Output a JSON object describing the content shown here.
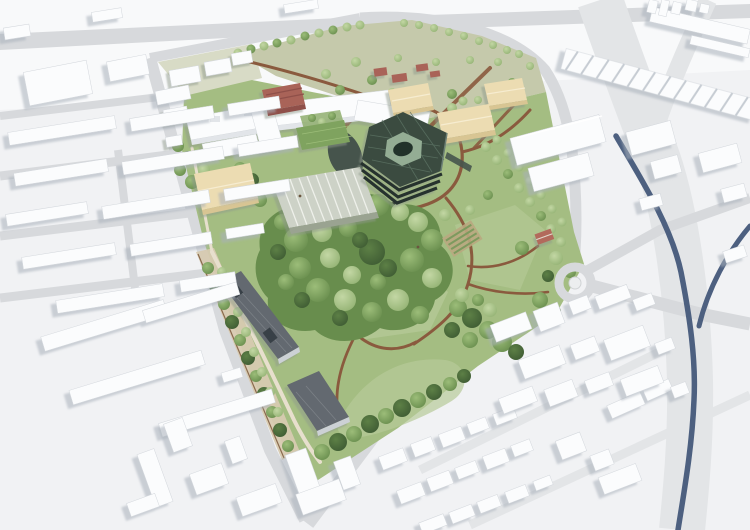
{
  "scene": {
    "type": "architectural-aerial-masterplan-rendering",
    "description": "Bird's-eye rendering of a green campus park with a faceted dark solar-roof hub building, greenhouse, lab buildings and tree-lined avenue, embedded in a white massing model of the surrounding town with roads, a roundabout and a dark curving highway",
    "has_visible_text": false
  },
  "elements": [
    "context-city-white-massing",
    "light-roads",
    "dark-highway",
    "roundabout",
    "campus-site",
    "park-lawn",
    "forest-cluster",
    "tree-avenue",
    "hub-building-hexagonal",
    "pond",
    "greenhouse",
    "laboratory-complex",
    "brick-building",
    "sports-halls-beige",
    "farm-buildings-red",
    "dark-roof-buildings",
    "walled-garden-strip",
    "cottage",
    "kitchen-garden",
    "sawtooth-warehouse",
    "town-blocks-southeast",
    "row-housing-west"
  ],
  "palette": {
    "bg": "#f1f2f4",
    "bgSoft": "#f8f9fa",
    "road": "#d7d9dc",
    "roadWide": "#e3e5e7",
    "highway": "#4d6080",
    "buildingTop": "#fbfcfd",
    "buildingSide": "#e2e5e9",
    "buildingStroke": "#d3d7dc",
    "shadow": "#a9b0ba",
    "wallLight": "#ccd1d5",
    "lawn": "#a4bd82",
    "lawnLight": "#b7ca98",
    "olive": "#c5c9ab",
    "paleOlive": "#d8dbc6",
    "treeLightHi": "#c3d7a4",
    "treeLightLo": "#93b273",
    "treeMidHi": "#9cbd79",
    "treeMidLo": "#688d4d",
    "treeDarkHi": "#5d8046",
    "treeDarkLo": "#3e5b33",
    "path": "#8a5a3e",
    "sand": "#e7dfcd",
    "gardenTan": "#d7cab0",
    "beige": "#ecdcb2",
    "beigeSide": "#d8c593",
    "greenhouseRoof": "#cdd2c7",
    "greenhouseRidge": "#eef0ea",
    "greenRoof": "#7fa35e",
    "hexRoof": "#3a4c41",
    "hexGrid": "#5d7263",
    "hexCenter": "#94ad94",
    "hexCore": "#22302a",
    "hexFacade": "#27332d",
    "water": "#46544c",
    "brick": "#a96459",
    "brickRoof": "#8f5049",
    "darkRoof": "#63696f",
    "darkRoofLine": "#7b8187",
    "cottageRoof": "#b26a5b",
    "flower": "#a3584c"
  }
}
